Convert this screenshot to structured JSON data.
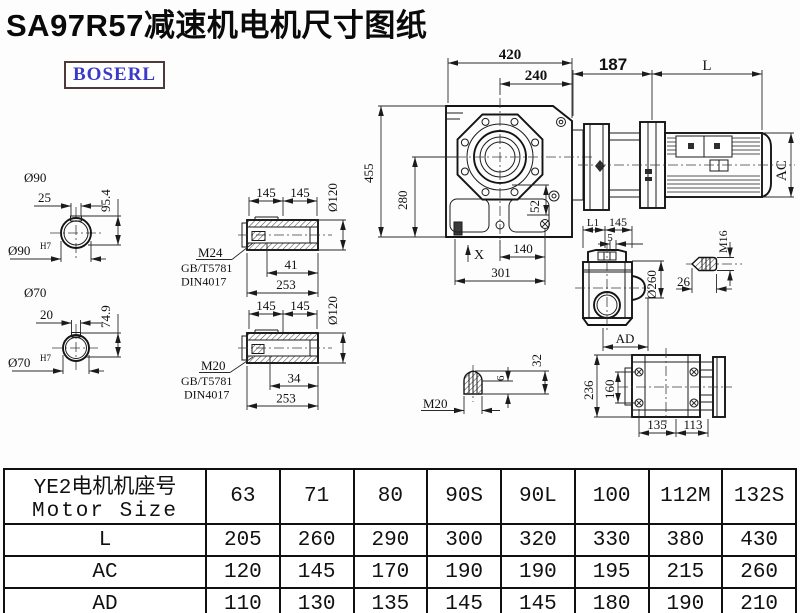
{
  "title": "SA97R57减速机电机尺寸图纸",
  "logo": {
    "text": "BOSERL"
  },
  "drawing": {
    "shaft90": {
      "diameter": "Ø90",
      "keyway_width": "25",
      "height": "95.4",
      "bore": "Ø90",
      "tolerance": "H7"
    },
    "shaft70": {
      "diameter": "Ø70",
      "keyway_width": "20",
      "height": "74.9",
      "bore": "Ø70",
      "tolerance": "H7"
    },
    "sleeve_top": {
      "seg1": "145",
      "seg2": "145",
      "od": "Ø120",
      "thread": "M24",
      "std1": "GB/T5781",
      "std2": "DIN4017",
      "thread_len": "41",
      "total_len": "253"
    },
    "sleeve_bottom": {
      "seg1": "145",
      "seg2": "145",
      "od": "Ø120",
      "thread": "M20",
      "std1": "GB/T5781",
      "std2": "DIN4017",
      "thread_len": "34",
      "total_len": "253"
    },
    "front": {
      "width": "420",
      "flange_width": "240",
      "height": "455",
      "center_height": "280",
      "offset": "52",
      "x_mark": "X",
      "foot_len": "140",
      "base_len": "301"
    },
    "motor": {
      "adapter_len": "187",
      "length_label": "L",
      "ac_label": "AC"
    },
    "side": {
      "l1": "L1",
      "seg": "145",
      "gap": "5",
      "od": "Ø260",
      "ad_label": "AD"
    },
    "bolt_m16": {
      "thread": "M16",
      "length": "26"
    },
    "bolt_m20": {
      "thread": "M20",
      "tip": "6",
      "height": "32"
    },
    "bottom": {
      "height": "236",
      "hole_spacing": "160",
      "len1": "135",
      "len2": "113"
    }
  },
  "table": {
    "header_line1": "YE2电机机座号",
    "header_line2": "Motor Size",
    "frame_sizes": [
      "63",
      "71",
      "80",
      "90S",
      "90L",
      "100",
      "112M",
      "132S"
    ],
    "rows": [
      {
        "label": "L",
        "values": [
          "205",
          "260",
          "290",
          "300",
          "320",
          "330",
          "380",
          "430"
        ]
      },
      {
        "label": "AC",
        "values": [
          "120",
          "145",
          "170",
          "190",
          "190",
          "195",
          "215",
          "260"
        ]
      },
      {
        "label": "AD",
        "values": [
          "110",
          "130",
          "135",
          "145",
          "145",
          "180",
          "190",
          "210"
        ]
      }
    ]
  }
}
